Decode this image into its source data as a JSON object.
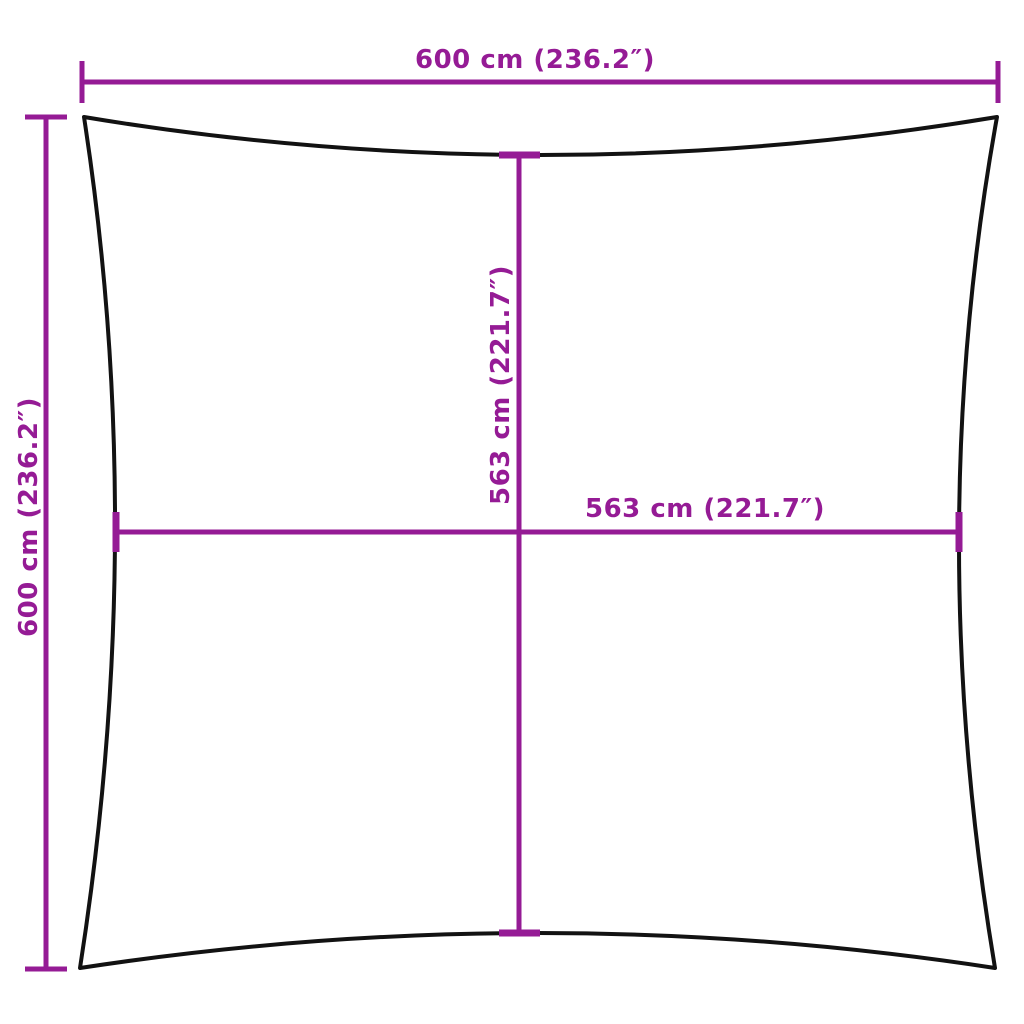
{
  "diagram": {
    "type": "product-dimension-diagram",
    "subject": "square shade sail with concave edges",
    "colors": {
      "background": "#ffffff",
      "dimension": "#951B95",
      "outline": "#121212"
    },
    "labels": {
      "top_width": "600 cm (236.2″)",
      "left_height": "600 cm (236.2″)",
      "inner_height": "563 cm (221.7″)",
      "inner_width": "563 cm (221.7″)"
    },
    "values": {
      "outer_width_cm": 600,
      "outer_width_in": 236.2,
      "outer_height_cm": 600,
      "outer_height_in": 236.2,
      "inner_width_cm": 563,
      "inner_width_in": 221.7,
      "inner_height_cm": 563,
      "inner_height_in": 221.7
    }
  }
}
